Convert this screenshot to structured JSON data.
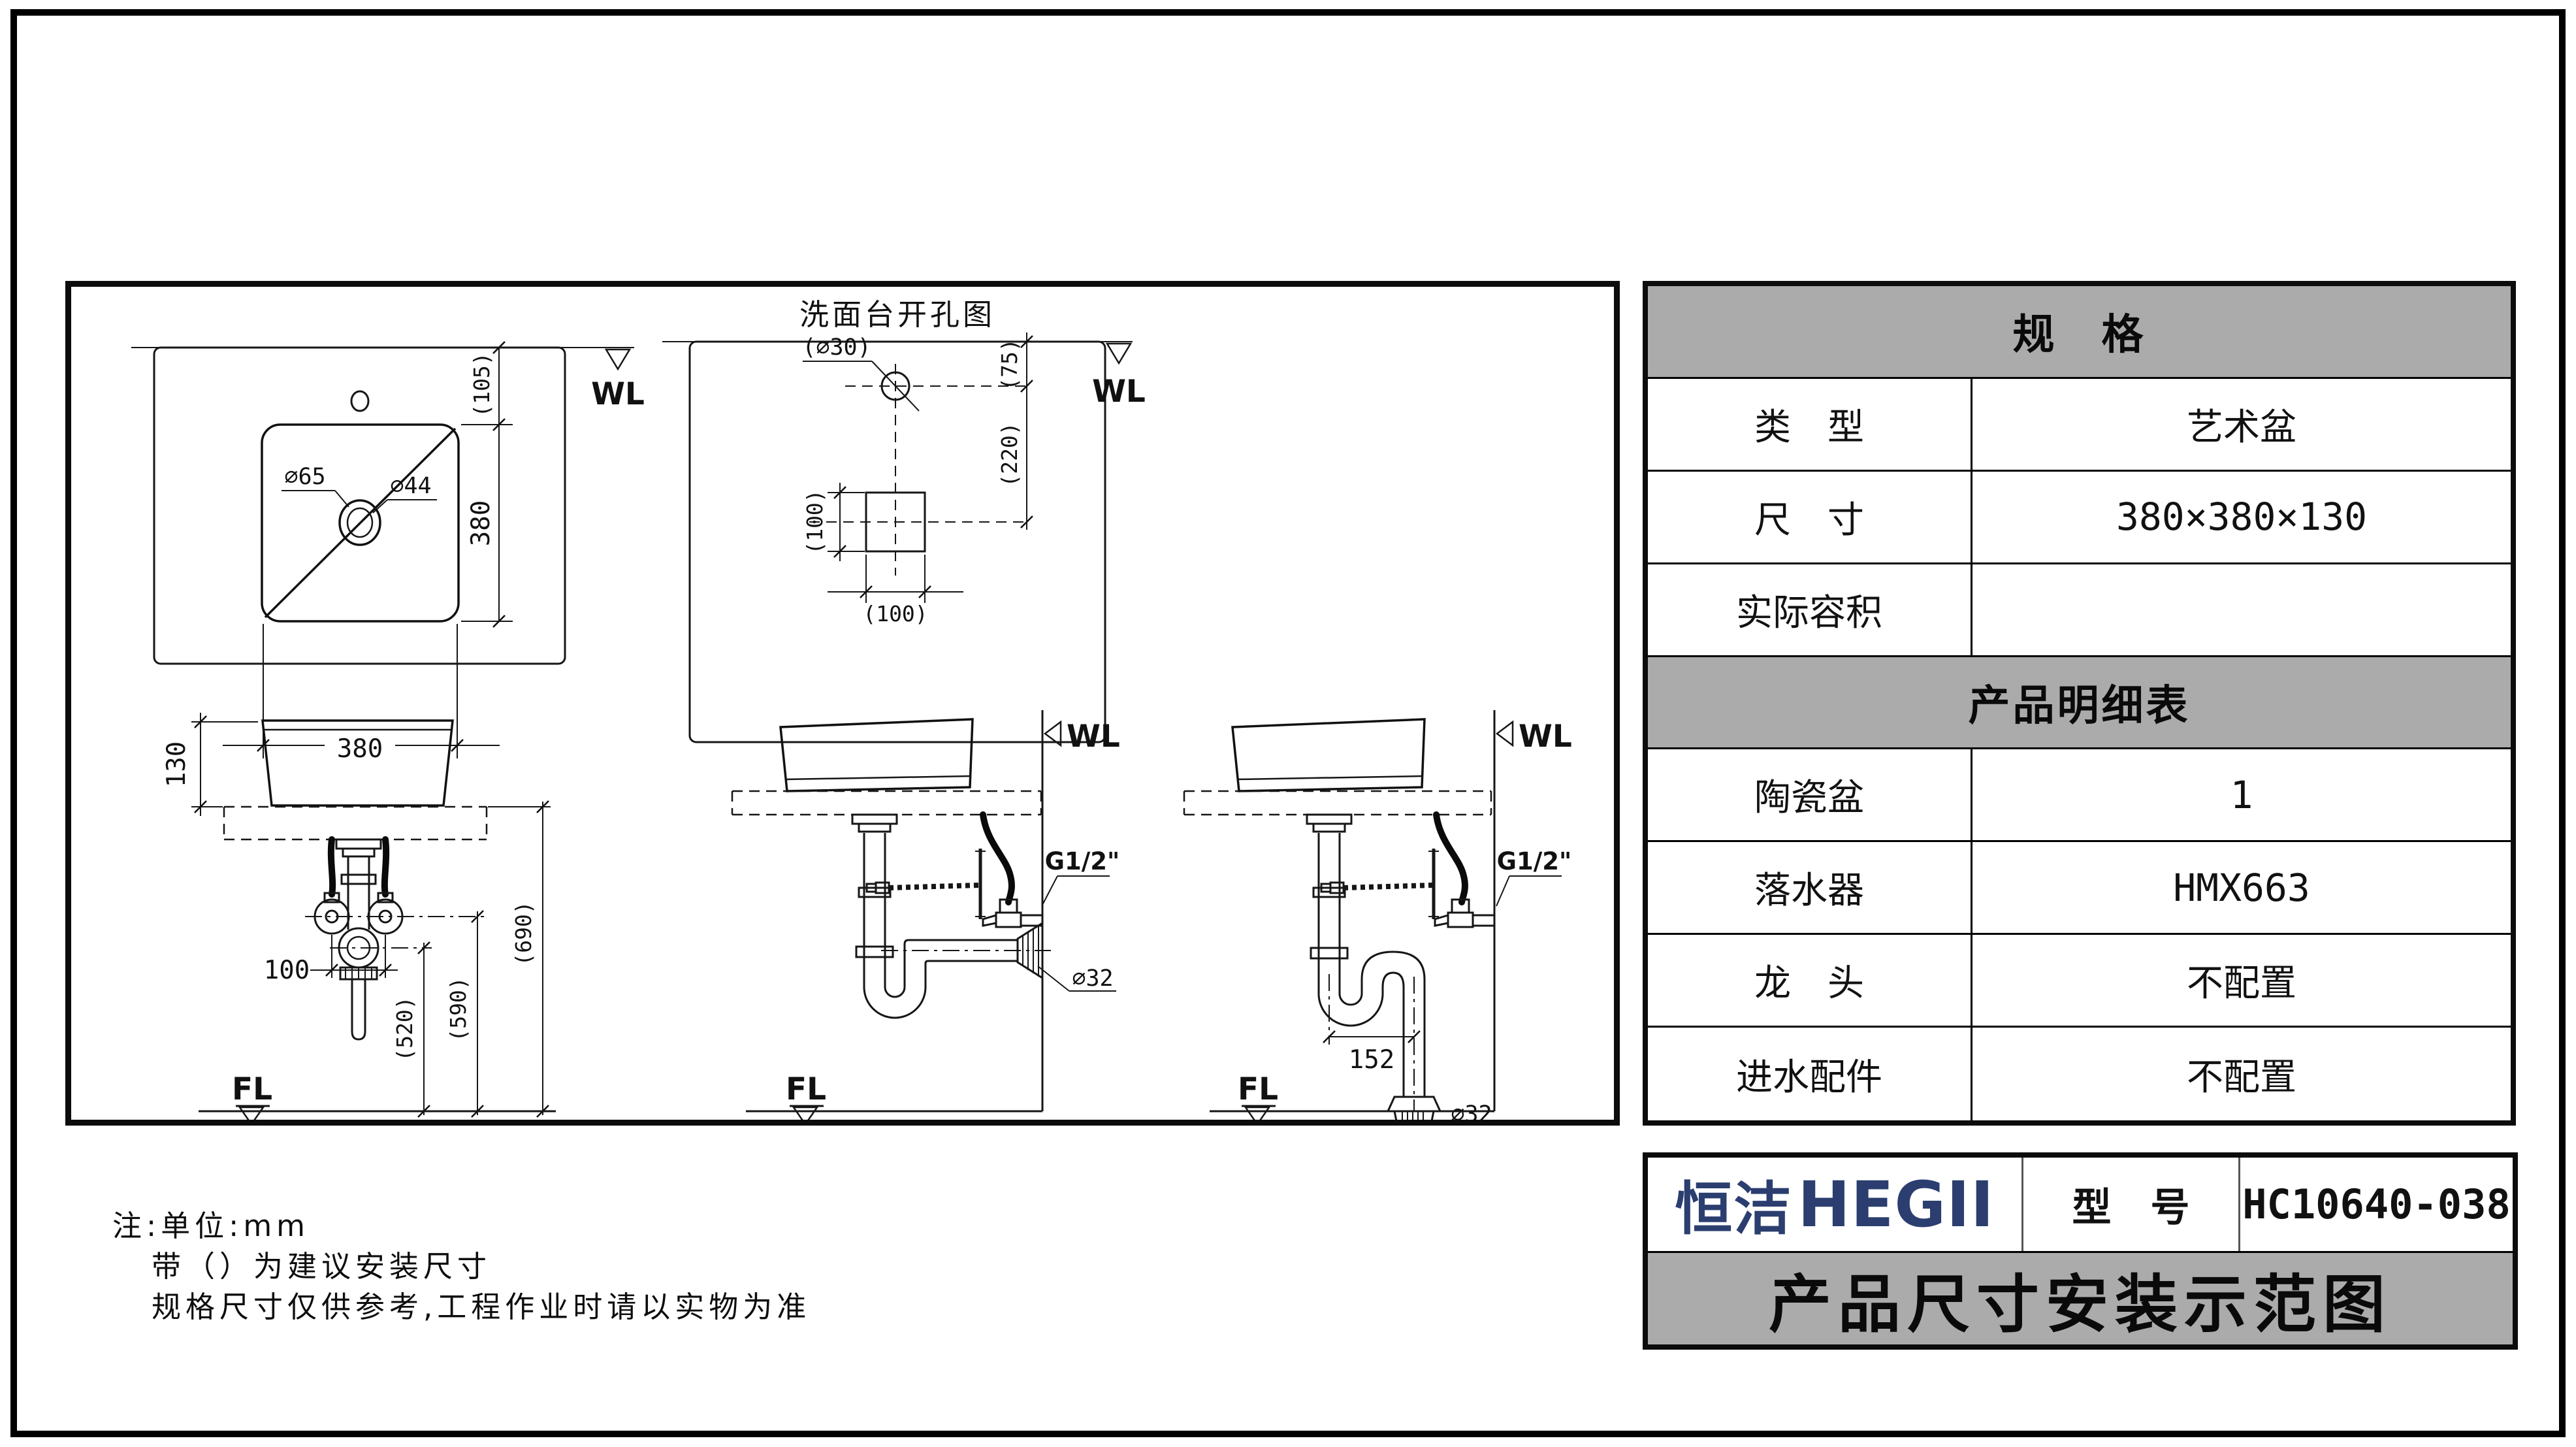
{
  "page": {
    "bg": "#ffffff",
    "line_color": "#161616",
    "header_gray": "#ababab",
    "brand_navy": "#2b3e6f"
  },
  "drawings": {
    "top_view": {
      "wl": "WL",
      "dim_offset": "(105)",
      "dim_height": "380",
      "dim_width": "380",
      "drain_outer": "∅65",
      "drain_inner": "∅44"
    },
    "cutout_view": {
      "title": "洗面台开孔图",
      "wl": "WL",
      "hole": "(∅30)",
      "dim_wall_to_hole": "(75)",
      "dim_hole_to_drain": "(220)",
      "dim_square_h": "(100)",
      "dim_square_w": "(100)"
    },
    "front_view": {
      "dim_basin_height": "130",
      "dim_valve_spacing": "100",
      "dim_trap_height": "(520)",
      "dim_valve_height": "(590)",
      "dim_counter_height": "(690)",
      "fl": "FL"
    },
    "wall_drain_view": {
      "wl": "WL",
      "thread": "G1/2\"",
      "drain_dia": "∅32",
      "fl": "FL"
    },
    "floor_drain_view": {
      "wl": "WL",
      "thread": "G1/2\"",
      "dim_trap_offset": "152",
      "drain_dia": "∅32",
      "fl": "FL"
    }
  },
  "notes": {
    "line1": "注:单位:mm",
    "line2": "带（）为建议安装尺寸",
    "line3": "规格尺寸仅供参考,工程作业时请以实物为准"
  },
  "spec_table": {
    "spec_header": "规　格",
    "rows": [
      {
        "label": "类　型",
        "value": "艺术盆"
      },
      {
        "label": "尺　寸",
        "value": "380×380×130"
      },
      {
        "label": "实际容积",
        "value": ""
      }
    ],
    "detail_header": "产品明细表",
    "detail_rows": [
      {
        "label": "陶瓷盆",
        "value": "1"
      },
      {
        "label": "落水器",
        "value": "HMX663"
      },
      {
        "label": "龙　头",
        "value": "不配置"
      },
      {
        "label": "进水配件",
        "value": "不配置"
      }
    ]
  },
  "title_block": {
    "brand_cn": "恒洁",
    "brand_en": "HEGII",
    "model_label": "型　号",
    "model_value": "HC10640-038",
    "doc_title": "产品尺寸安装示范图"
  }
}
